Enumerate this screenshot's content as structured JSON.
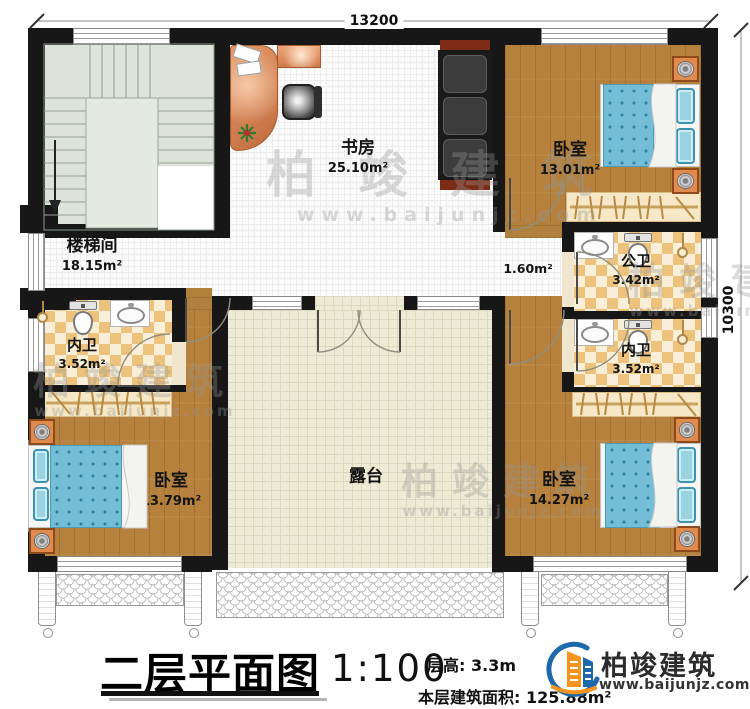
{
  "dimension_labels": {
    "top": "13200",
    "right": "10300"
  },
  "rooms": {
    "stairwell": {
      "name": "楼梯间",
      "area": "18.15m²"
    },
    "study": {
      "name": "书房",
      "area": "25.10m²"
    },
    "bedroom_top_right": {
      "name": "卧室",
      "area": "13.01m²"
    },
    "public_bathroom": {
      "name": "公卫",
      "area": "3.42m²"
    },
    "ensuite_bathroom_right": {
      "name": "内卫",
      "area": "3.52m²"
    },
    "ensuite_bathroom_left": {
      "name": "内卫",
      "area": "3.52m²"
    },
    "bedroom_bottom_left": {
      "name": "卧室",
      "area": "13.79m²"
    },
    "bedroom_bottom_right": {
      "name": "卧室",
      "area": "14.27m²"
    },
    "terrace": {
      "name": "露台"
    },
    "hallway": {
      "area": "1.60m²"
    },
    "stair_down_label": "下"
  },
  "title_block": {
    "title": "二层平面图",
    "scale": "1:100",
    "floor_height_label": "层高:",
    "floor_height_value": "3.3m",
    "floor_area_label": "本层建筑面积:",
    "floor_area_value": "125.88m²"
  },
  "brand": {
    "name": "柏竣建筑",
    "website": "www.baijunjz.com"
  },
  "watermark": {
    "text": "柏竣建筑",
    "url": "www.baijunjz.com"
  },
  "colors": {
    "wall": "#171717",
    "wood_floor": "#b5813c",
    "bed": "#74bdd6",
    "checker_tile": "#ecc27c",
    "terrace_floor": "#edead5",
    "desk": "#d98a5e",
    "logo_blue": "#1d69ac",
    "logo_orange": "#f7941d"
  }
}
